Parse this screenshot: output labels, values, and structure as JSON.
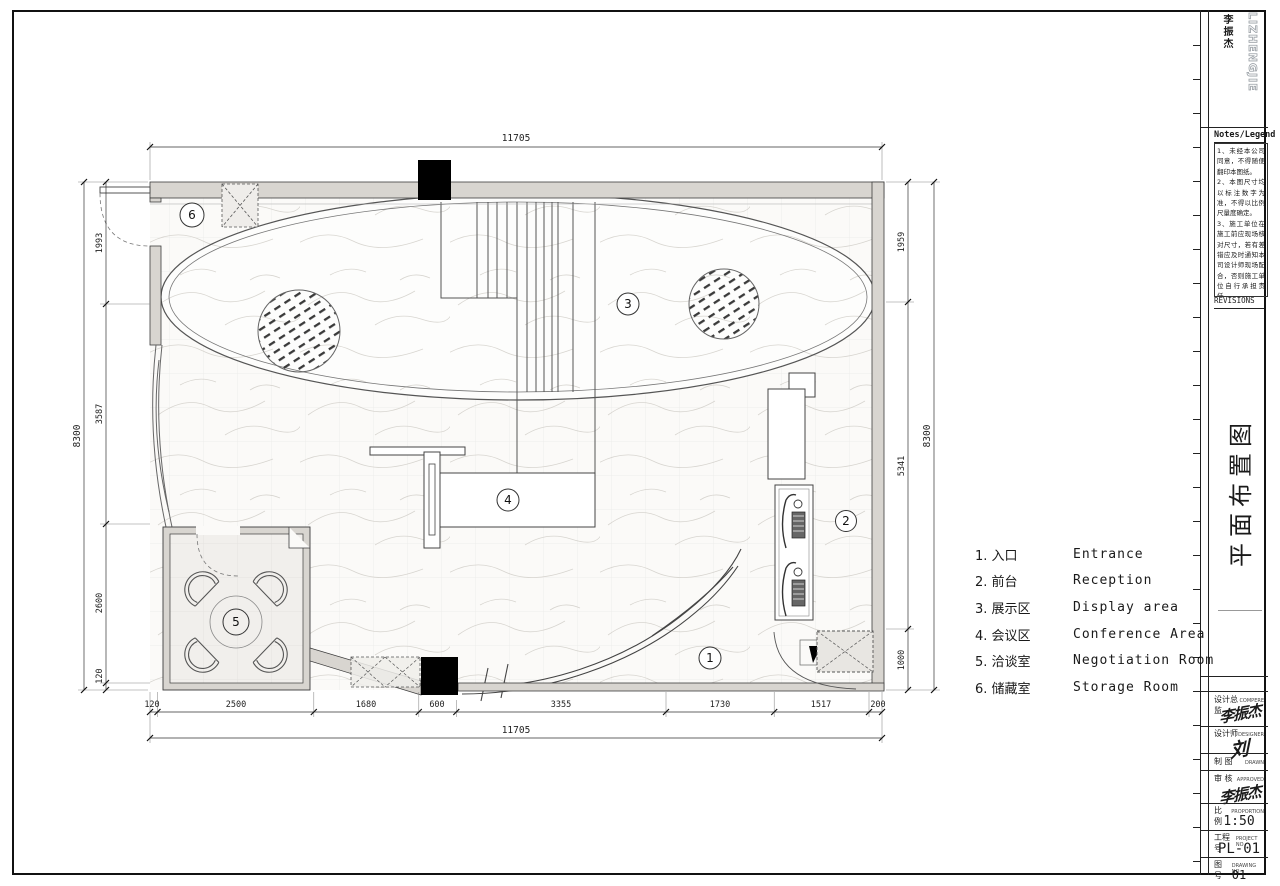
{
  "colors": {
    "paper": "#ffffff",
    "line": "#3c3c3c",
    "wall_fill": "#d8d5d0",
    "column_fill": "#000000"
  },
  "logo": {
    "cn": "李振杰",
    "en": "LIZHENGJIE"
  },
  "notes": {
    "header": "Notes/Legend",
    "lines": [
      "1、未经本公司同意，不得随便翻印本图纸。",
      "2、本图尺寸均以标注数字为准，不得以比例尺量度确定。",
      "3、施工单位在施工前应现场核对尺寸，若有差错应及时通知本司设计师现场配合，否则施工单位自行承担责任。",
      "4、施工单位应于施工前提供本设计所选用装修材料的样品、色板，并经设计师认可后，方可实施施工。"
    ]
  },
  "revisions_label": "REVISIONS",
  "drawing_title": "平面布置图",
  "titleblock": {
    "compere_cn": "设计总监",
    "compere_en": "COMPERE",
    "compere_sig": "李振杰",
    "designer_cn": "设计师",
    "designer_en": "DESIGNER",
    "designer_sig": "刘",
    "drawn_cn": "制 图",
    "drawn_en": "DRAWN",
    "approved_cn": "审 核",
    "approved_en": "APPROVED",
    "approved_sig": "李振杰",
    "proportion_cn": "比 例",
    "proportion_en": "PROPORTION",
    "proportion_value": "1:50",
    "project_cn": "工程号",
    "project_en": "PROJECT NO",
    "project_value": "PL-01",
    "drawingno_cn": "图 号",
    "drawingno_en": "DRAWING NO",
    "drawingno_value": "01"
  },
  "legend": {
    "items": [
      {
        "cn": "1. 入口",
        "en": "Entrance"
      },
      {
        "cn": "2. 前台",
        "en": "Reception"
      },
      {
        "cn": "3. 展示区",
        "en": "Display area"
      },
      {
        "cn": "4. 会议区",
        "en": "Conference Area"
      },
      {
        "cn": "5. 洽谈室",
        "en": "Negotiation Room"
      },
      {
        "cn": "6. 储藏室",
        "en": "Storage Room"
      }
    ]
  },
  "plan": {
    "room_numbers": [
      "1",
      "2",
      "3",
      "4",
      "5",
      "6"
    ],
    "dimensions": {
      "top_total": "11705",
      "bottom_total": "11705",
      "bottom_chain": [
        "120",
        "2500",
        "1680",
        "600",
        "3355",
        "1730",
        "1517",
        "200"
      ],
      "left_total": "8300",
      "left_chain": [
        "1993",
        "3587",
        "2600",
        "120"
      ],
      "right_total": "8300",
      "right_chain": [
        "1959",
        "5341",
        "1000"
      ]
    }
  }
}
